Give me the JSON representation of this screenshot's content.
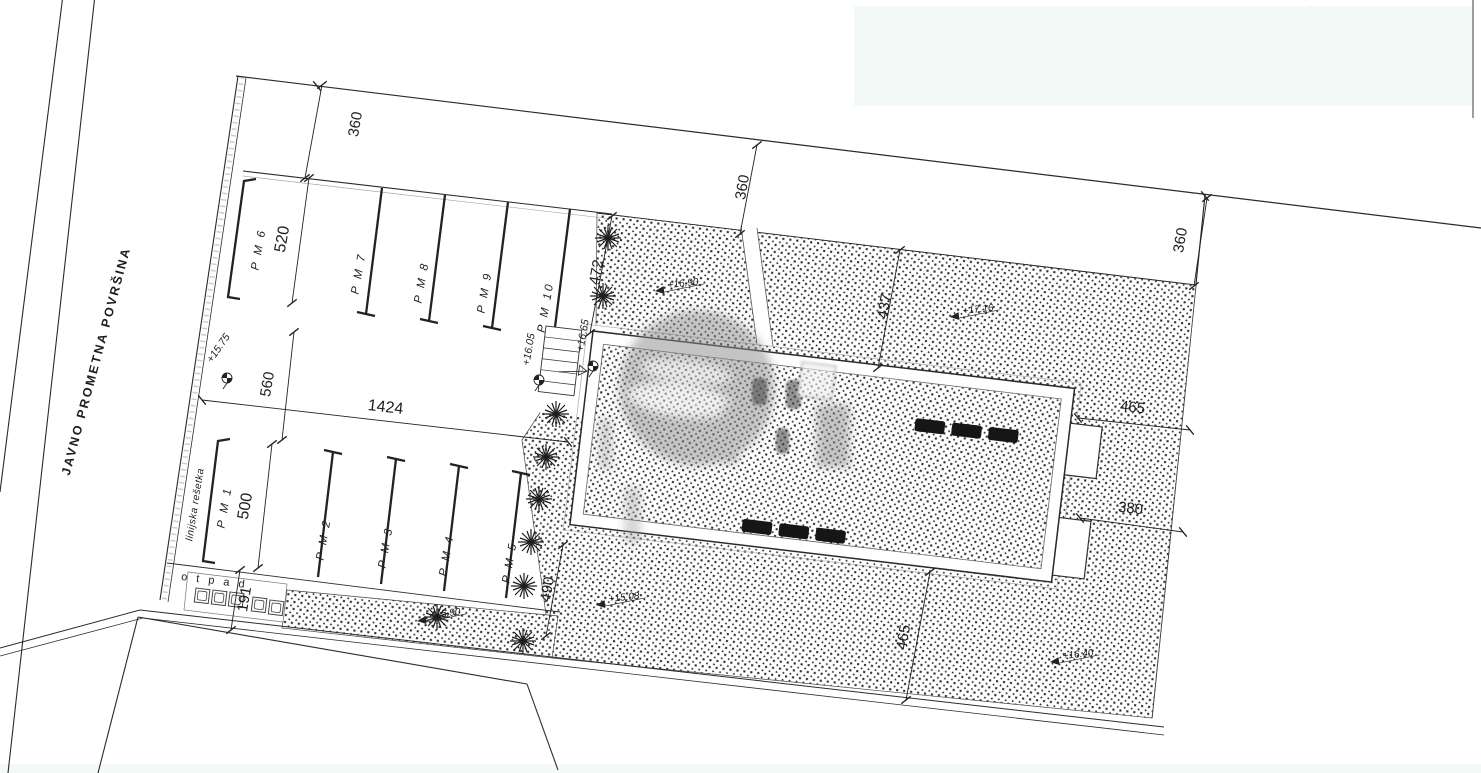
{
  "drawing": {
    "clipped_title": "SITUACIJA GRAĐEVNE ČESTICE S PRIKAZOM REŽIMA KORIŠTENJA VANJSKIH POVRŠINA, PARKIRALIŠNIH MJESTA I VISINSKIH KOTA TERENA",
    "road_label": "JAVNO PROMETNA POVRŠINA",
    "waste_label": "o t p a d",
    "grate_label": "linijska rešetka"
  },
  "parking_spots": {
    "pm1": "P M  1",
    "pm2": "P M  2",
    "pm3": "P M  3",
    "pm4": "P M  4",
    "pm5": "P M  5",
    "pm6": "P M  6",
    "pm7": "P M  7",
    "pm8": "P M  8",
    "pm9": "P M  9",
    "pm10": "P M  10"
  },
  "dimensions": {
    "setback_front": "360",
    "setback_mid": "360",
    "setback_right": "360",
    "pm6_width": "520",
    "green_strip": "472",
    "aisle": "560",
    "row_length": "1424",
    "pm1_width": "500",
    "waste": "191",
    "south_strip": "490",
    "front_yard": "437",
    "east_yard_upper": "465",
    "east_yard_lower": "380",
    "south_yard": "465"
  },
  "elevations": {
    "bm_street": "+15.75",
    "bm_path": "+16.05",
    "bm_entry": "+16.65",
    "terrain_upper": "+16.90",
    "terrain_ne": "+17.16",
    "terrain_parking": "+15.90",
    "terrain_sw": "+15.08",
    "terrain_se": "+16.40"
  },
  "colors": {
    "line": "#2a2a2a",
    "hatch": "#2b2b2b",
    "paper": "#ffffff",
    "tint": "#e8f4ee"
  }
}
